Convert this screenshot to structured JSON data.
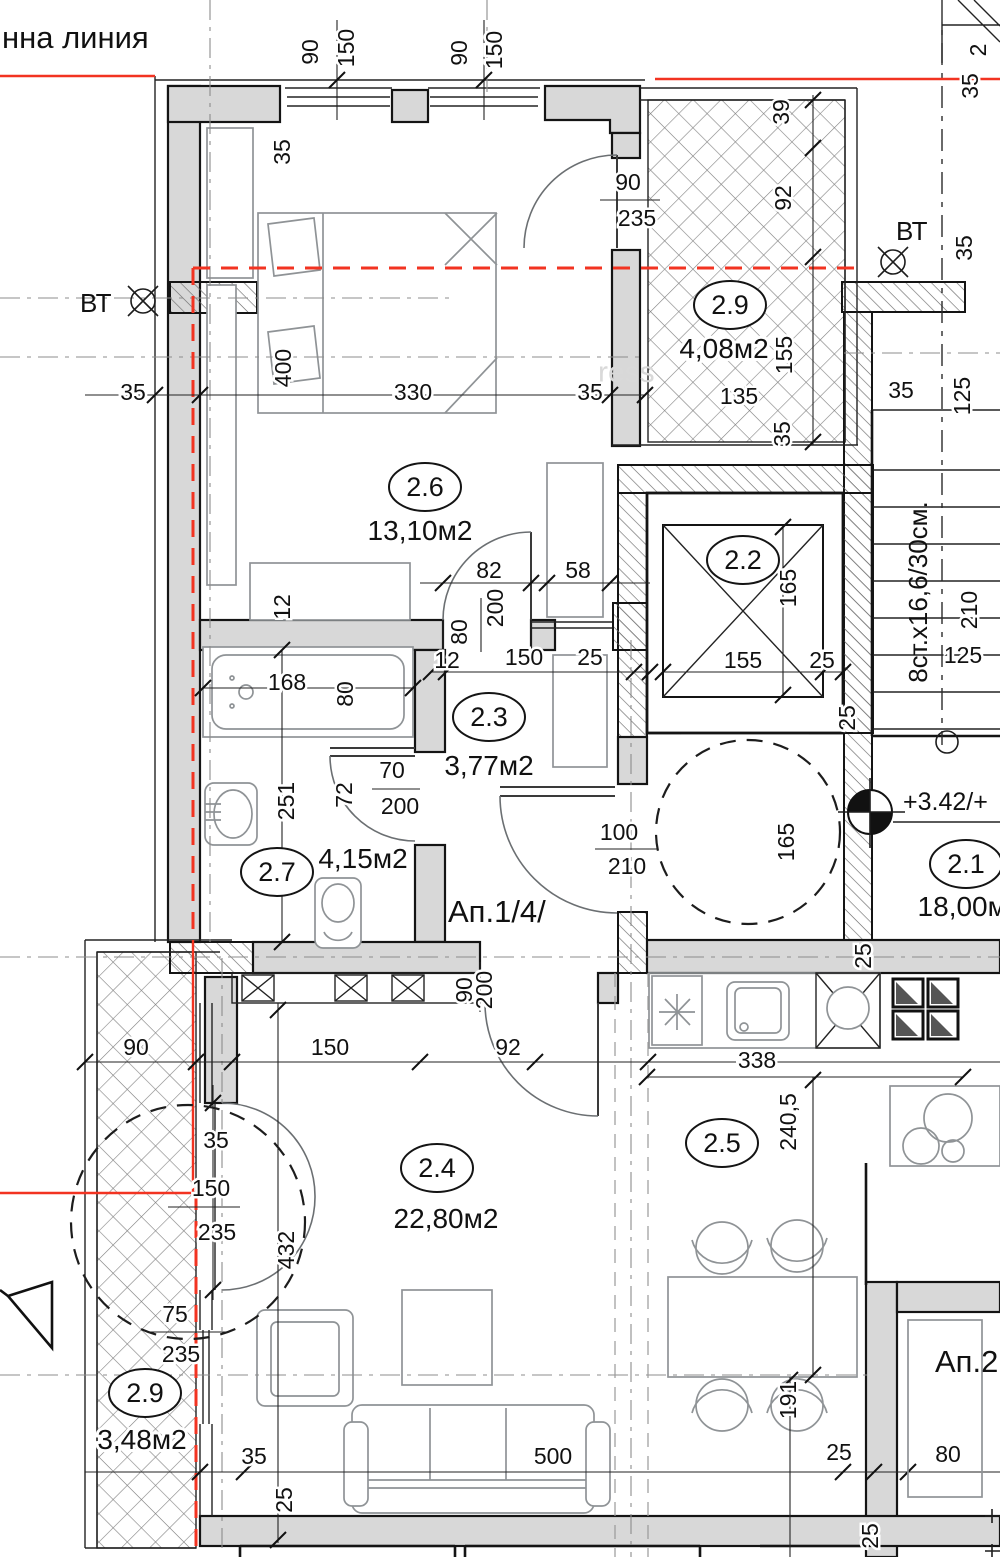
{
  "texts": {
    "regulation_line": "нна линия",
    "bt_left": "ВТ",
    "bt_right": "ВТ",
    "apartment_label": "Ап.1/4/",
    "apartment2_label": "Ап.2",
    "stairs_label": "8ст.х16,6/30см.",
    "elevation_mark": "+3.42/+",
    "corner_mark": "2",
    "watermark": "ress"
  },
  "colors": {
    "wall_fill": "#d8d8d8",
    "line": "#141414",
    "red_boundary": "#f23321",
    "furniture": "#8f9396"
  },
  "rooms": [
    {
      "number": "2.6",
      "area": "13,10м2",
      "ex": 425,
      "ey": 487,
      "ax": 420,
      "ay": 540
    },
    {
      "number": "2.9",
      "area": "4,08м2",
      "ex": 730,
      "ey": 305,
      "ax": 724,
      "ay": 358
    },
    {
      "number": "2.2",
      "area": "",
      "ex": 743,
      "ey": 560,
      "ax": 0,
      "ay": 0
    },
    {
      "number": "2.3",
      "area": "3,77м2",
      "ex": 489,
      "ey": 717,
      "ax": 489,
      "ay": 775
    },
    {
      "number": "2.7",
      "area": "4,15м2",
      "ex": 277,
      "ey": 872,
      "ax": 363,
      "ay": 868
    },
    {
      "number": "2.1",
      "area": "18,00м2",
      "ex": 966,
      "ey": 864,
      "ax": 970,
      "ay": 916
    },
    {
      "number": "2.4",
      "area": "22,80м2",
      "ex": 437,
      "ey": 1168,
      "ax": 446,
      "ay": 1228
    },
    {
      "number": "2.5",
      "area": "",
      "ex": 722,
      "ey": 1143,
      "ax": 0,
      "ay": 0
    },
    {
      "number": "2.9",
      "area": "3,48м2",
      "ex": 145,
      "ey": 1393,
      "ax": 142,
      "ay": 1449
    }
  ],
  "dims": [
    {
      "t": "90",
      "x": 318,
      "y": 52,
      "r": 1
    },
    {
      "t": "150",
      "x": 354,
      "y": 48,
      "r": 1
    },
    {
      "t": "90",
      "x": 467,
      "y": 53,
      "r": 1
    },
    {
      "t": "150",
      "x": 502,
      "y": 50,
      "r": 1
    },
    {
      "t": "35",
      "x": 290,
      "y": 152,
      "r": 1
    },
    {
      "t": "90",
      "x": 628,
      "y": 190
    },
    {
      "t": "235",
      "x": 637,
      "y": 226
    },
    {
      "t": "39",
      "x": 789,
      "y": 112,
      "r": 1
    },
    {
      "t": "92",
      "x": 791,
      "y": 198,
      "r": 1
    },
    {
      "t": "155",
      "x": 792,
      "y": 355,
      "r": 1
    },
    {
      "t": "135",
      "x": 739,
      "y": 404
    },
    {
      "t": "35",
      "x": 790,
      "y": 434,
      "r": 1
    },
    {
      "t": "35",
      "x": 978,
      "y": 86,
      "r": 1
    },
    {
      "t": "35",
      "x": 972,
      "y": 248,
      "r": 1
    },
    {
      "t": "125",
      "x": 970,
      "y": 396,
      "r": 1
    },
    {
      "t": "35",
      "x": 901,
      "y": 398
    },
    {
      "t": "210",
      "x": 977,
      "y": 610,
      "r": 1
    },
    {
      "t": "125",
      "x": 963,
      "y": 663
    },
    {
      "t": "25",
      "x": 855,
      "y": 718,
      "r": 1
    },
    {
      "t": "35",
      "x": 133,
      "y": 400
    },
    {
      "t": "400",
      "x": 291,
      "y": 368,
      "r": 1
    },
    {
      "t": "330",
      "x": 413,
      "y": 400
    },
    {
      "t": "35",
      "x": 590,
      "y": 400
    },
    {
      "t": "12",
      "x": 290,
      "y": 607,
      "r": 1
    },
    {
      "t": "82",
      "x": 489,
      "y": 578
    },
    {
      "t": "200",
      "x": 503,
      "y": 608,
      "r": 1
    },
    {
      "t": "80",
      "x": 467,
      "y": 632,
      "r": 1
    },
    {
      "t": "58",
      "x": 578,
      "y": 578
    },
    {
      "t": "12",
      "x": 447,
      "y": 668
    },
    {
      "t": "150",
      "x": 524,
      "y": 665
    },
    {
      "t": "25",
      "x": 590,
      "y": 665
    },
    {
      "t": "155",
      "x": 743,
      "y": 668
    },
    {
      "t": "25",
      "x": 822,
      "y": 668
    },
    {
      "t": "165",
      "x": 796,
      "y": 588,
      "r": 1
    },
    {
      "t": "168",
      "x": 287,
      "y": 690
    },
    {
      "t": "80",
      "x": 353,
      "y": 694,
      "r": 1
    },
    {
      "t": "251",
      "x": 294,
      "y": 801,
      "r": 1
    },
    {
      "t": "72",
      "x": 352,
      "y": 795,
      "r": 1
    },
    {
      "t": "70",
      "x": 392,
      "y": 778
    },
    {
      "t": "200",
      "x": 400,
      "y": 814
    },
    {
      "t": "100",
      "x": 619,
      "y": 840
    },
    {
      "t": "210",
      "x": 627,
      "y": 874
    },
    {
      "t": "165",
      "x": 794,
      "y": 842,
      "r": 1
    },
    {
      "t": "90",
      "x": 472,
      "y": 990,
      "r": 1
    },
    {
      "t": "200",
      "x": 492,
      "y": 990,
      "r": 1
    },
    {
      "t": "90",
      "x": 136,
      "y": 1055
    },
    {
      "t": "150",
      "x": 330,
      "y": 1055
    },
    {
      "t": "92",
      "x": 508,
      "y": 1055
    },
    {
      "t": "338",
      "x": 757,
      "y": 1068
    },
    {
      "t": "25",
      "x": 871,
      "y": 956,
      "r": 1
    },
    {
      "t": "240,5",
      "x": 796,
      "y": 1122,
      "r": 1
    },
    {
      "t": "35",
      "x": 216,
      "y": 1148
    },
    {
      "t": "150",
      "x": 211,
      "y": 1196
    },
    {
      "t": "235",
      "x": 217,
      "y": 1240
    },
    {
      "t": "432",
      "x": 294,
      "y": 1250,
      "r": 1
    },
    {
      "t": "75",
      "x": 175,
      "y": 1322
    },
    {
      "t": "235",
      "x": 181,
      "y": 1362
    },
    {
      "t": "191",
      "x": 796,
      "y": 1400,
      "r": 1
    },
    {
      "t": "35",
      "x": 254,
      "y": 1464
    },
    {
      "t": "25",
      "x": 292,
      "y": 1500,
      "r": 1
    },
    {
      "t": "500",
      "x": 553,
      "y": 1464
    },
    {
      "t": "25",
      "x": 839,
      "y": 1460
    },
    {
      "t": "80",
      "x": 948,
      "y": 1462
    },
    {
      "t": "25",
      "x": 878,
      "y": 1536,
      "r": 1
    }
  ]
}
